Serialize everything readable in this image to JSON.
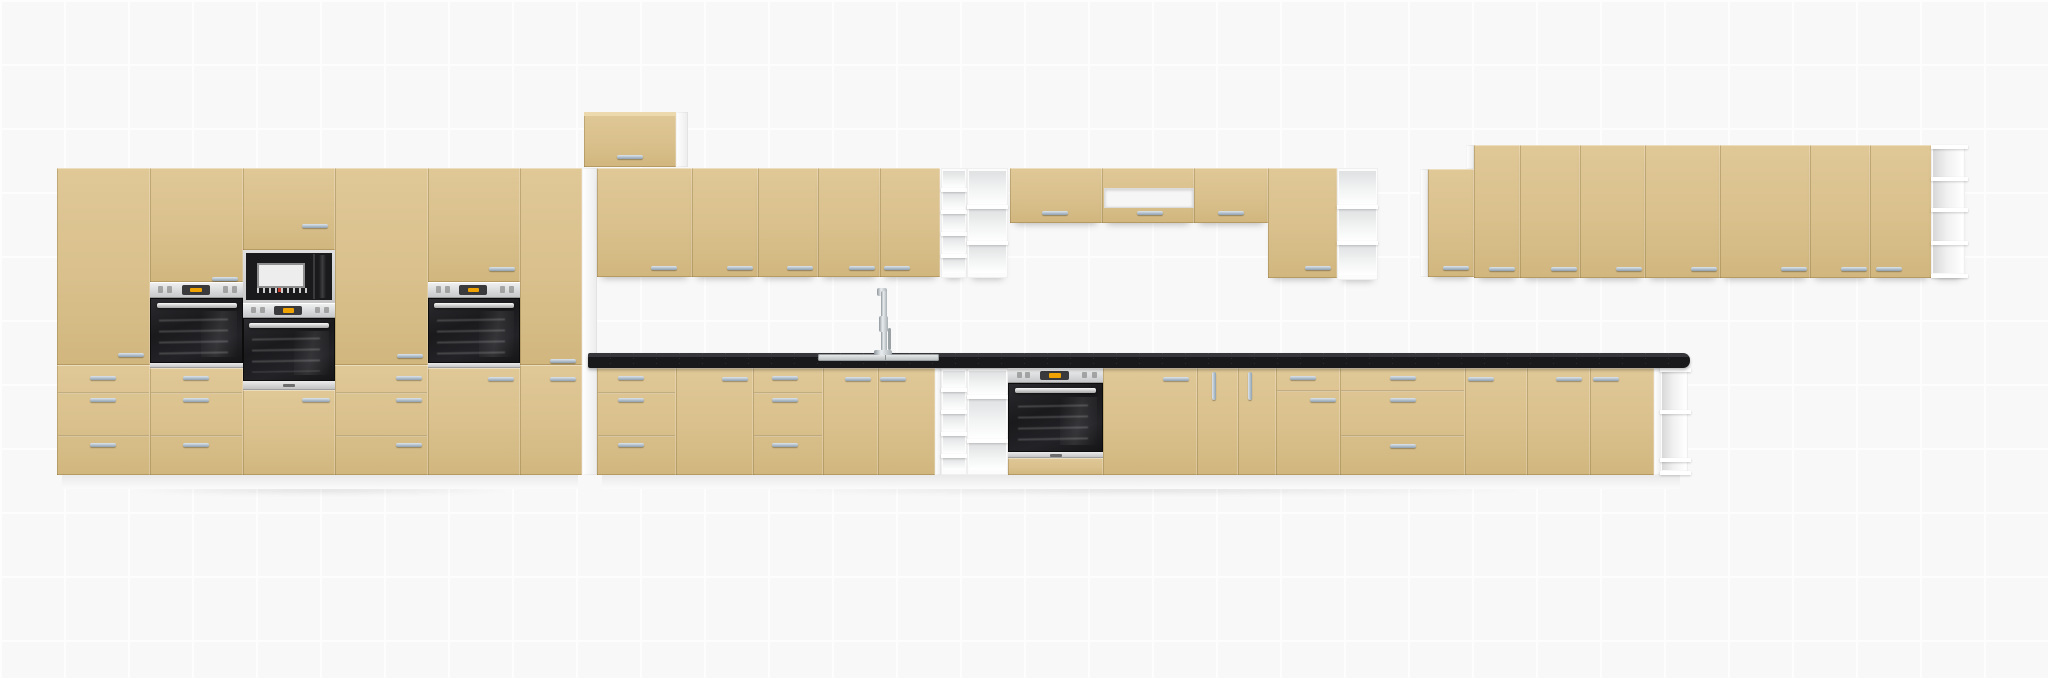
{
  "canvas": {
    "width": 2048,
    "height": 678,
    "grid_size": 64,
    "background": "#f8f8f8",
    "grid_line": "#fdfdfd"
  },
  "colors": {
    "cabinet_front": "#d9c08c",
    "cabinet_front_light": "#e0c897",
    "cabinet_front_dark": "#d1b67e",
    "carcass_white": "#f4f4f4",
    "countertop": "#1a1a1d",
    "countertop_speckle": "#ffffff",
    "handle_steel": "#a9bac8",
    "appliance_black": "#1b1b1d",
    "appliance_steel": "#d8d8d8",
    "display_orange": "#f0a300",
    "microwave_button_red": "#c0392b"
  },
  "modules": [
    {
      "n": "floor-shadow-tall-run",
      "k": "shadow",
      "x": 48,
      "y": 483,
      "w": 545,
      "h": 14
    },
    {
      "n": "floor-shadow-base-run",
      "k": "shadow",
      "x": 594,
      "y": 483,
      "w": 1100,
      "h": 14
    },
    {
      "n": "tall-plinth",
      "k": "plinth",
      "x": 62,
      "y": 475,
      "w": 516,
      "h": 14
    },
    {
      "n": "base-plinth",
      "k": "plinth",
      "x": 602,
      "y": 475,
      "w": 1078,
      "h": 14
    },
    {
      "n": "tall-run-side-panel",
      "k": "white",
      "x": 582,
      "y": 168,
      "w": 15,
      "h": 307
    },
    {
      "n": "bridge-side-panel",
      "k": "white",
      "x": 676,
      "y": 112,
      "w": 12,
      "h": 55
    },
    {
      "n": "base-filler-panel",
      "k": "white",
      "x": 935,
      "y": 368,
      "w": 6,
      "h": 107
    },
    {
      "n": "wall-right-side-panel",
      "k": "white",
      "x": 1420,
      "y": 169,
      "w": 8,
      "h": 108
    },
    {
      "n": "wall-right-step-panel",
      "k": "white",
      "x": 1466,
      "y": 145,
      "w": 8,
      "h": 24
    },
    {
      "n": "base-end-panel",
      "k": "white",
      "x": 1654,
      "y": 368,
      "w": 8,
      "h": 107
    },
    {
      "n": "tall-cab-1-upper-door",
      "k": "front",
      "x": 57,
      "y": 168,
      "w": 93,
      "h": 197,
      "handles": [
        [
          118,
          353,
          26,
          4
        ]
      ]
    },
    {
      "n": "tall-cab-1-drawers",
      "k": "front",
      "x": 57,
      "y": 365,
      "w": 93,
      "h": 110,
      "seams": [
        392,
        435
      ],
      "handles": [
        [
          90,
          376,
          26,
          4
        ],
        [
          90,
          398,
          26,
          4
        ],
        [
          90,
          443,
          26,
          4
        ]
      ]
    },
    {
      "n": "tall-cab-2-upper-door",
      "k": "front",
      "x": 150,
      "y": 168,
      "w": 93,
      "h": 114,
      "handles": [
        [
          212,
          277,
          26,
          4
        ]
      ]
    },
    {
      "n": "tall-cab-2-oven-control-panel",
      "k": "ovenpanel",
      "x": 150,
      "y": 282,
      "w": 93,
      "h": 16
    },
    {
      "n": "tall-cab-2-oven-door",
      "k": "ovendoor",
      "x": 150,
      "y": 298,
      "w": 93,
      "h": 65
    },
    {
      "n": "tall-cab-2-oven-strip",
      "k": "steelstrip",
      "x": 150,
      "y": 363,
      "w": 93,
      "h": 5
    },
    {
      "n": "tall-cab-2-drawers",
      "k": "front",
      "x": 150,
      "y": 368,
      "w": 93,
      "h": 107,
      "seams": [
        392,
        435
      ],
      "handles": [
        [
          183,
          376,
          26,
          4
        ],
        [
          183,
          398,
          26,
          4
        ],
        [
          183,
          443,
          26,
          4
        ]
      ]
    },
    {
      "n": "tall-cab-3-upper-door",
      "k": "front",
      "x": 243,
      "y": 168,
      "w": 92,
      "h": 82,
      "handles": [
        [
          302,
          224,
          26,
          4
        ]
      ]
    },
    {
      "n": "tall-cab-3-microwave",
      "k": "microwave",
      "x": 243,
      "y": 250,
      "w": 92,
      "h": 53
    },
    {
      "n": "tall-cab-3-microwave-control-panel",
      "k": "ovenpanel",
      "x": 243,
      "y": 303,
      "w": 92,
      "h": 15
    },
    {
      "n": "tall-cab-3-oven-door",
      "k": "ovendoor",
      "x": 243,
      "y": 318,
      "w": 92,
      "h": 63
    },
    {
      "n": "tall-cab-3-oven-strip",
      "k": "steelstrip",
      "x": 243,
      "y": 381,
      "w": 92,
      "h": 9,
      "logo": true
    },
    {
      "n": "tall-cab-3-lower-door",
      "k": "front",
      "x": 243,
      "y": 390,
      "w": 92,
      "h": 85,
      "handles": [
        [
          302,
          398,
          28,
          4
        ]
      ]
    },
    {
      "n": "tall-cab-4-upper-door",
      "k": "front",
      "x": 335,
      "y": 168,
      "w": 93,
      "h": 197,
      "handles": [
        [
          397,
          354,
          26,
          4
        ]
      ]
    },
    {
      "n": "tall-cab-4-drawers",
      "k": "front",
      "x": 335,
      "y": 365,
      "w": 93,
      "h": 110,
      "seams": [
        392,
        435
      ],
      "handles": [
        [
          396,
          376,
          26,
          4
        ],
        [
          396,
          398,
          26,
          4
        ],
        [
          396,
          443,
          26,
          4
        ]
      ]
    },
    {
      "n": "tall-cab-5-upper-door",
      "k": "front",
      "x": 428,
      "y": 168,
      "w": 92,
      "h": 114,
      "handles": [
        [
          489,
          267,
          26,
          4
        ]
      ]
    },
    {
      "n": "tall-cab-5-oven-control-panel",
      "k": "ovenpanel",
      "x": 428,
      "y": 282,
      "w": 92,
      "h": 16
    },
    {
      "n": "tall-cab-5-oven-door",
      "k": "ovendoor",
      "x": 428,
      "y": 298,
      "w": 92,
      "h": 65
    },
    {
      "n": "tall-cab-5-oven-strip",
      "k": "steelstrip",
      "x": 428,
      "y": 363,
      "w": 92,
      "h": 5
    },
    {
      "n": "tall-cab-5-lower-door",
      "k": "front",
      "x": 428,
      "y": 368,
      "w": 92,
      "h": 107,
      "handles": [
        [
          488,
          377,
          26,
          4
        ]
      ]
    },
    {
      "n": "tall-cab-6-upper-door",
      "k": "front",
      "x": 520,
      "y": 168,
      "w": 62,
      "h": 197,
      "handles": [
        [
          550,
          359,
          26,
          4
        ]
      ]
    },
    {
      "n": "tall-cab-6-lower-door",
      "k": "front",
      "x": 520,
      "y": 365,
      "w": 62,
      "h": 110,
      "handles": [
        [
          550,
          377,
          26,
          4
        ]
      ]
    },
    {
      "n": "bridge-wall-cabinet",
      "k": "front",
      "x": 584,
      "y": 112,
      "w": 92,
      "h": 55,
      "cap": true,
      "handles": [
        [
          617,
          155,
          26,
          4
        ]
      ]
    },
    {
      "n": "wall-cab-door-1",
      "k": "front",
      "wall": true,
      "x": 597,
      "y": 168,
      "w": 95,
      "h": 109,
      "handles": [
        [
          651,
          266,
          26,
          4
        ]
      ]
    },
    {
      "n": "wall-cab-door-2",
      "k": "front",
      "wall": true,
      "x": 692,
      "y": 168,
      "w": 66,
      "h": 109,
      "handles": [
        [
          727,
          266,
          26,
          4
        ]
      ]
    },
    {
      "n": "wall-cab-door-3",
      "k": "front",
      "wall": true,
      "x": 758,
      "y": 168,
      "w": 60,
      "h": 109,
      "handles": [
        [
          787,
          266,
          26,
          4
        ]
      ]
    },
    {
      "n": "wall-cab-door-4",
      "k": "front",
      "wall": true,
      "x": 818,
      "y": 168,
      "w": 62,
      "h": 109,
      "handles": [
        [
          849,
          266,
          26,
          4
        ]
      ]
    },
    {
      "n": "wall-cab-door-5",
      "k": "front",
      "wall": true,
      "x": 880,
      "y": 168,
      "w": 60,
      "h": 109,
      "handles": [
        [
          884,
          266,
          26,
          4
        ]
      ]
    },
    {
      "n": "wall-open-cubby-column",
      "k": "cubbies",
      "wall": true,
      "x": 941,
      "y": 168,
      "w": 26,
      "h": 110,
      "shelves": [
        190,
        212,
        234,
        256
      ]
    },
    {
      "n": "wall-open-shelf-unit-1",
      "k": "shelf-front",
      "wall": true,
      "x": 967,
      "y": 168,
      "w": 41,
      "h": 110,
      "shelves": [
        207,
        243
      ]
    },
    {
      "n": "wall-short-door-1",
      "k": "front",
      "wall": true,
      "x": 1010,
      "y": 168,
      "w": 92,
      "h": 55,
      "handles": [
        [
          1042,
          211,
          26,
          4
        ]
      ]
    },
    {
      "n": "wall-hood-cabinet",
      "k": "front",
      "wall": true,
      "x": 1102,
      "y": 168,
      "w": 92,
      "h": 55,
      "inset": [
        1104,
        188,
        88,
        18
      ],
      "handles": [
        [
          1137,
          211,
          26,
          4
        ]
      ]
    },
    {
      "n": "wall-short-door-2",
      "k": "front",
      "wall": true,
      "x": 1194,
      "y": 168,
      "w": 74,
      "h": 55,
      "handles": [
        [
          1218,
          211,
          26,
          4
        ]
      ]
    },
    {
      "n": "wall-cab-door-6",
      "k": "front",
      "wall": true,
      "x": 1268,
      "y": 168,
      "w": 69,
      "h": 110,
      "handles": [
        [
          1305,
          266,
          26,
          4
        ]
      ]
    },
    {
      "n": "wall-open-shelf-unit-2",
      "k": "shelf-front",
      "wall": true,
      "x": 1337,
      "y": 168,
      "w": 41,
      "h": 112,
      "shelves": [
        207,
        243
      ]
    },
    {
      "n": "wall-right-door-1",
      "k": "front",
      "wall": true,
      "x": 1428,
      "y": 169,
      "w": 46,
      "h": 108,
      "handles": [
        [
          1443,
          266,
          26,
          4
        ]
      ]
    },
    {
      "n": "wall-right-door-2",
      "k": "front",
      "wall": true,
      "x": 1474,
      "y": 145,
      "w": 46,
      "h": 133,
      "handles": [
        [
          1489,
          267,
          26,
          4
        ]
      ]
    },
    {
      "n": "wall-right-door-3",
      "k": "front",
      "wall": true,
      "x": 1520,
      "y": 145,
      "w": 60,
      "h": 133,
      "handles": [
        [
          1551,
          267,
          26,
          4
        ]
      ]
    },
    {
      "n": "wall-right-door-4",
      "k": "front",
      "wall": true,
      "x": 1580,
      "y": 145,
      "w": 65,
      "h": 133,
      "handles": [
        [
          1616,
          267,
          26,
          4
        ]
      ]
    },
    {
      "n": "wall-right-door-5",
      "k": "front",
      "wall": true,
      "x": 1645,
      "y": 145,
      "w": 75,
      "h": 133,
      "handles": [
        [
          1691,
          267,
          26,
          4
        ]
      ]
    },
    {
      "n": "wall-right-door-6",
      "k": "front",
      "wall": true,
      "x": 1720,
      "y": 145,
      "w": 90,
      "h": 133,
      "handles": [
        [
          1781,
          267,
          26,
          4
        ]
      ]
    },
    {
      "n": "wall-right-door-7",
      "k": "front",
      "wall": true,
      "x": 1810,
      "y": 145,
      "w": 60,
      "h": 133,
      "handles": [
        [
          1841,
          267,
          26,
          4
        ]
      ]
    },
    {
      "n": "wall-right-door-8",
      "k": "front",
      "wall": true,
      "x": 1870,
      "y": 145,
      "w": 62,
      "h": 133,
      "handles": [
        [
          1876,
          267,
          26,
          4
        ]
      ]
    },
    {
      "n": "wall-right-end-open-shelf",
      "k": "shelf-side",
      "wall": true,
      "x": 1931,
      "y": 145,
      "w": 34,
      "h": 133,
      "shelves": [
        179,
        210,
        243
      ]
    },
    {
      "n": "base-drawer-unit-1",
      "k": "front",
      "x": 597,
      "y": 368,
      "w": 79,
      "h": 107,
      "seams": [
        392,
        435
      ],
      "handles": [
        [
          618,
          376,
          26,
          4
        ],
        [
          618,
          398,
          26,
          4
        ],
        [
          618,
          443,
          26,
          4
        ]
      ]
    },
    {
      "n": "base-door-1",
      "k": "front",
      "x": 676,
      "y": 368,
      "w": 77,
      "h": 107,
      "handles": [
        [
          722,
          377,
          26,
          4
        ]
      ]
    },
    {
      "n": "base-drawer-unit-2",
      "k": "front",
      "x": 753,
      "y": 368,
      "w": 70,
      "h": 107,
      "seams": [
        392,
        435
      ],
      "handles": [
        [
          772,
          376,
          26,
          4
        ],
        [
          772,
          398,
          26,
          4
        ],
        [
          772,
          443,
          26,
          4
        ]
      ]
    },
    {
      "n": "base-sink-door-left",
      "k": "front",
      "x": 823,
      "y": 368,
      "w": 55,
      "h": 107,
      "handles": [
        [
          845,
          377,
          26,
          4
        ]
      ]
    },
    {
      "n": "base-sink-door-right",
      "k": "front",
      "x": 878,
      "y": 368,
      "w": 57,
      "h": 107,
      "handles": [
        [
          880,
          377,
          26,
          4
        ]
      ]
    },
    {
      "n": "base-open-cubby-column",
      "k": "cubbies",
      "x": 941,
      "y": 368,
      "w": 26,
      "h": 107,
      "shelves": [
        390,
        412,
        434,
        456
      ]
    },
    {
      "n": "base-open-shelf-unit",
      "k": "shelf-front",
      "x": 967,
      "y": 368,
      "w": 41,
      "h": 107,
      "shelves": [
        397,
        441
      ]
    },
    {
      "n": "base-oven-control-panel",
      "k": "ovenpanel",
      "x": 1008,
      "y": 368,
      "w": 95,
      "h": 15
    },
    {
      "n": "base-oven-door",
      "k": "ovendoor",
      "x": 1008,
      "y": 383,
      "w": 95,
      "h": 69
    },
    {
      "n": "base-oven-strip",
      "k": "steelstrip",
      "x": 1008,
      "y": 452,
      "w": 95,
      "h": 6,
      "logo": true
    },
    {
      "n": "base-oven-drawer-front",
      "k": "front",
      "x": 1008,
      "y": 458,
      "w": 95,
      "h": 17
    },
    {
      "n": "base-door-2",
      "k": "front",
      "x": 1103,
      "y": 368,
      "w": 94,
      "h": 107,
      "handles": [
        [
          1163,
          377,
          26,
          4
        ]
      ]
    },
    {
      "n": "base-door-3",
      "k": "front",
      "x": 1197,
      "y": 368,
      "w": 41,
      "h": 107,
      "handles": [
        [
          1212,
          372,
          4,
          28
        ]
      ]
    },
    {
      "n": "base-door-4",
      "k": "front",
      "x": 1238,
      "y": 368,
      "w": 38,
      "h": 107,
      "handles": [
        [
          1248,
          372,
          4,
          28
        ]
      ]
    },
    {
      "n": "base-drawer-door-unit",
      "k": "front",
      "x": 1276,
      "y": 368,
      "w": 64,
      "h": 107,
      "seams": [
        390
      ],
      "handles": [
        [
          1290,
          376,
          26,
          4
        ],
        [
          1310,
          398,
          26,
          4
        ]
      ]
    },
    {
      "n": "base-drawer-unit-3",
      "k": "front",
      "x": 1340,
      "y": 368,
      "w": 125,
      "h": 107,
      "seams": [
        390,
        435
      ],
      "handles": [
        [
          1390,
          376,
          26,
          4
        ],
        [
          1390,
          398,
          26,
          4
        ],
        [
          1390,
          444,
          26,
          4
        ]
      ]
    },
    {
      "n": "base-door-5",
      "k": "front",
      "x": 1465,
      "y": 368,
      "w": 62,
      "h": 107,
      "handles": [
        [
          1468,
          377,
          26,
          4
        ]
      ]
    },
    {
      "n": "base-door-6",
      "k": "front",
      "x": 1527,
      "y": 368,
      "w": 63,
      "h": 107,
      "handles": [
        [
          1556,
          377,
          26,
          4
        ]
      ]
    },
    {
      "n": "base-door-7",
      "k": "front",
      "x": 1590,
      "y": 368,
      "w": 64,
      "h": 107,
      "handles": [
        [
          1593,
          377,
          26,
          4
        ]
      ]
    },
    {
      "n": "base-end-open-shelf",
      "k": "shelf-side",
      "x": 1660,
      "y": 368,
      "w": 28,
      "h": 107,
      "shelves": [
        412,
        460
      ]
    },
    {
      "n": "countertop",
      "k": "counter",
      "x": 588,
      "y": 353,
      "w": 1102,
      "h": 15
    },
    {
      "n": "sink",
      "k": "sink",
      "x": 818,
      "y": 354,
      "w": 121,
      "h": 7
    },
    {
      "n": "faucet",
      "k": "faucet",
      "x": 872,
      "y": 288,
      "w": 22,
      "h": 67
    }
  ]
}
